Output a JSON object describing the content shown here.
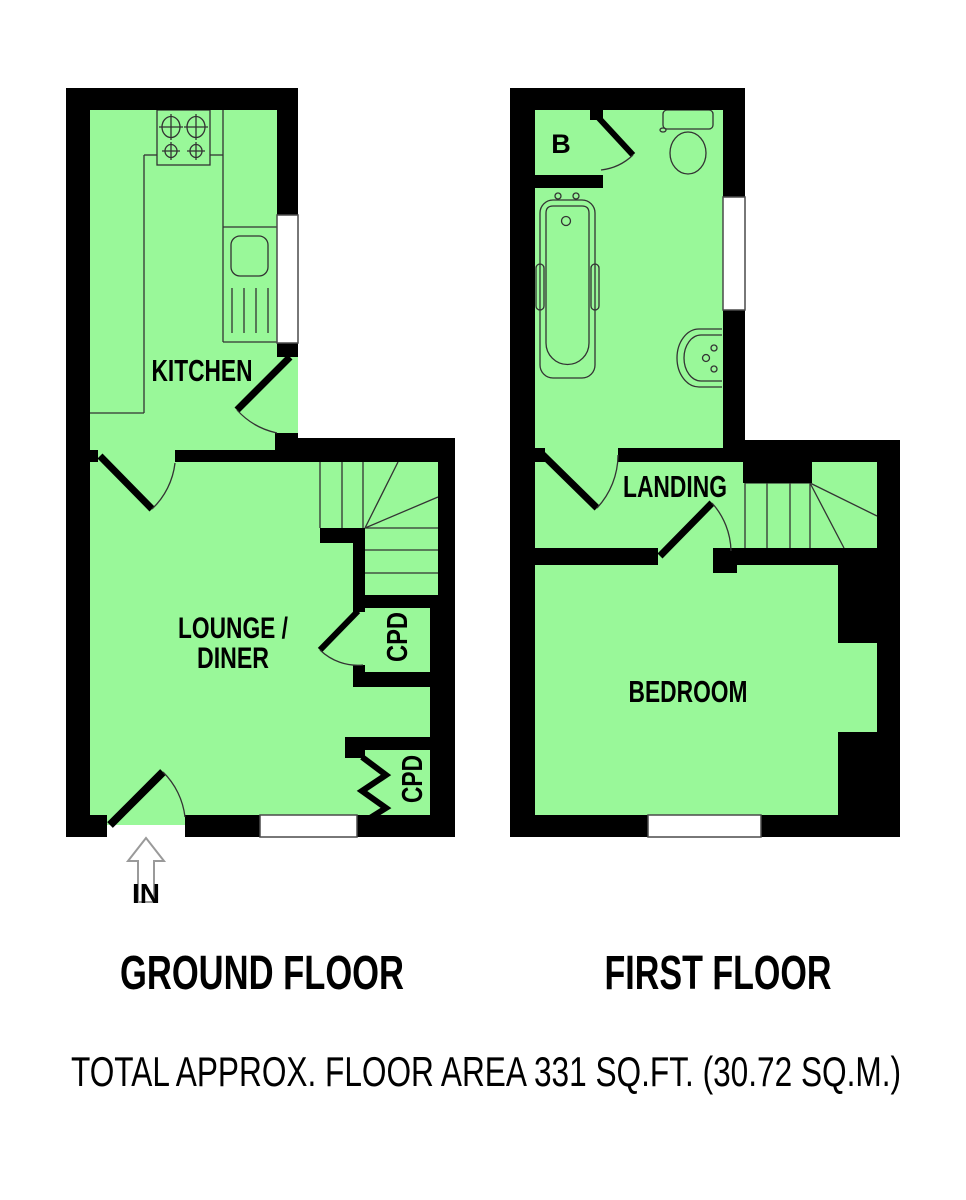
{
  "colors": {
    "floor_fill": "#99f899",
    "wall": "#000000",
    "fixture_line": "#333333",
    "window_fill": "#ffffff",
    "arrow_outline": "#9a9a9a"
  },
  "ground_floor": {
    "title": "GROUND FLOOR",
    "rooms": {
      "kitchen": "KITCHEN",
      "lounge_line1": "LOUNGE /",
      "lounge_line2": "DINER",
      "cupboard_upper": "CPD",
      "cupboard_lower": "CPD"
    },
    "entrance_label": "IN",
    "fixtures": [
      "hob",
      "counter",
      "sink-drainer",
      "winder-stairs",
      "entrance-door",
      "back-door",
      "windows"
    ]
  },
  "first_floor": {
    "title": "FIRST FLOOR",
    "rooms": {
      "boiler_cupboard": "B",
      "landing": "LANDING",
      "bedroom": "BEDROOM"
    },
    "fixtures": [
      "bath",
      "toilet",
      "basin",
      "winder-stairs",
      "windows"
    ]
  },
  "footer": {
    "total_area": "TOTAL APPROX. FLOOR AREA 331 SQ.FT. (30.72 SQ.M.)"
  }
}
